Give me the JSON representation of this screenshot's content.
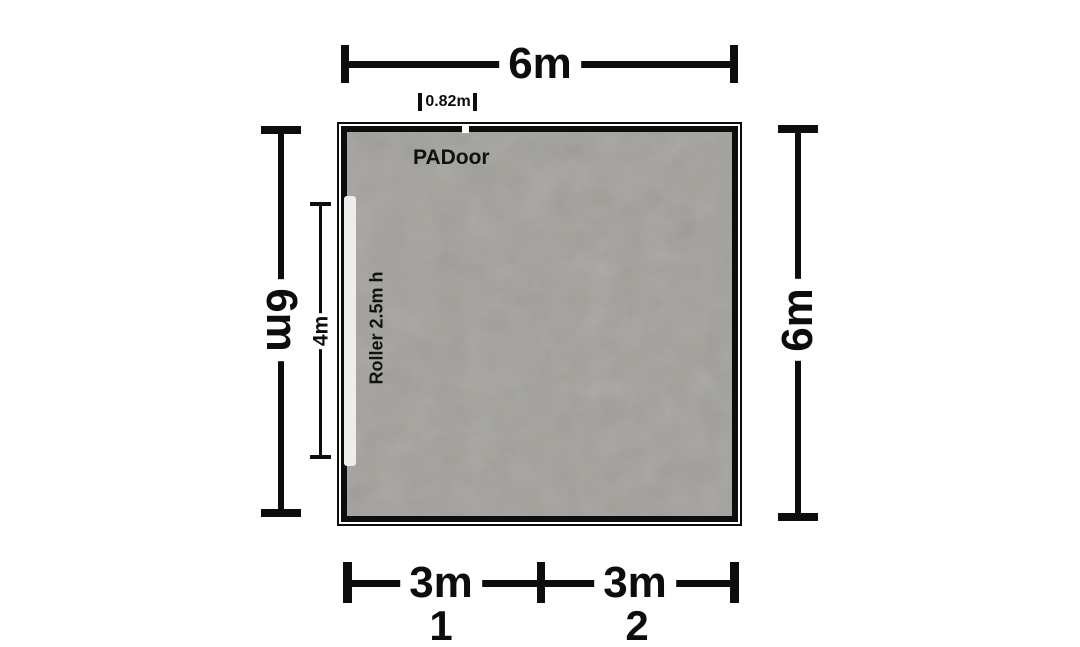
{
  "colors": {
    "background": "#ffffff",
    "wall": "#0d0d0d",
    "floor": "#a6a49e",
    "roller_door": "#eeede9",
    "dimension": "#0d0d0d"
  },
  "room": {
    "pa_door": {
      "label": "PADoor"
    },
    "roller_door": {
      "label": "Roller 2.5m h"
    }
  },
  "dimensions": {
    "top_width": {
      "label": "6m"
    },
    "door_width": {
      "label": "0.82m"
    },
    "left_height": {
      "label": "6m"
    },
    "right_height": {
      "label": "6m"
    },
    "roller_length": {
      "label": "4m"
    },
    "bottom": {
      "segments": [
        {
          "label": "3m",
          "number": "1"
        },
        {
          "label": "3m",
          "number": "2"
        }
      ]
    }
  }
}
